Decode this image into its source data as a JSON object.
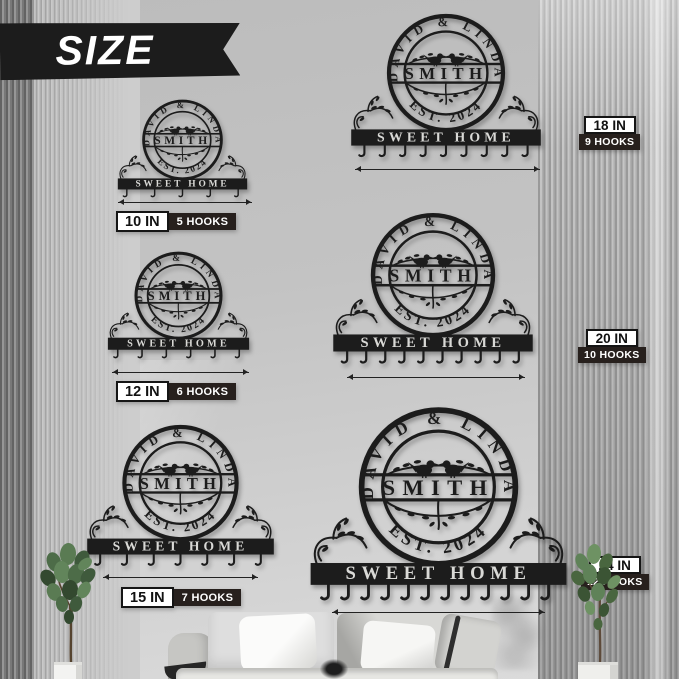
{
  "header": {
    "banner_label": "SIZE"
  },
  "sign_art": {
    "top_names": "DAVID & LINDA",
    "family_name": "SMITH",
    "established": "EST. 2024",
    "bottom_text": "SWEET HOME"
  },
  "signs": [
    {
      "id": "s10",
      "size_label": "10 IN",
      "hooks_label": "5 HOOKS",
      "hooks": 5
    },
    {
      "id": "s12",
      "size_label": "12 IN",
      "hooks_label": "6 HOOKS",
      "hooks": 6
    },
    {
      "id": "s15",
      "size_label": "15 IN",
      "hooks_label": "7 HOOKS",
      "hooks": 7
    },
    {
      "id": "s18",
      "size_label": "18 IN",
      "hooks_label": "9 HOOKS",
      "hooks": 9
    },
    {
      "id": "s20",
      "size_label": "20 IN",
      "hooks_label": "10 HOOKS",
      "hooks": 10
    },
    {
      "id": "s24",
      "size_label": "24 IN",
      "hooks_label": "12 HOOKS",
      "hooks": 12
    }
  ],
  "colors": {
    "sign_metal": "#1c1c1c",
    "badge_dark_bg": "#27201d",
    "badge_light_bg": "#ffffff",
    "badge_border": "#151515",
    "wall": "#c6c6c6"
  }
}
